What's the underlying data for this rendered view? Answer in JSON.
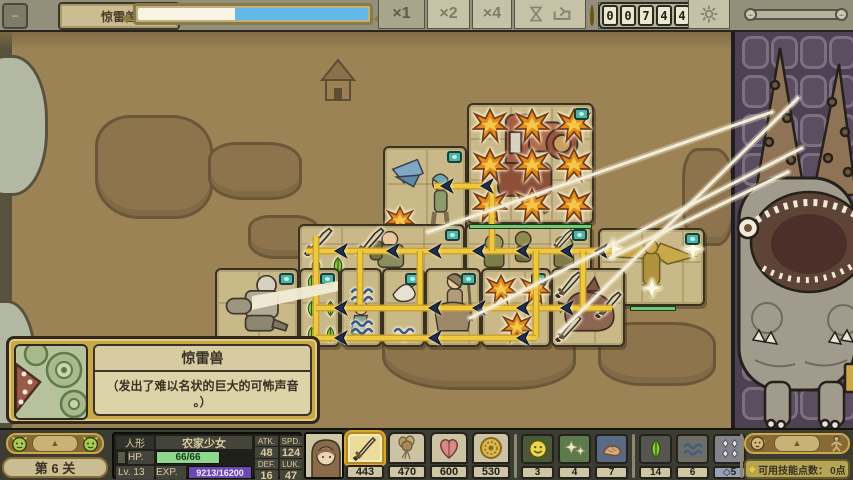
{
  "top_bar": {
    "minimize_icon": "circle-minus-icon",
    "enemy_name": "惊雷兽",
    "enemy_hp_left_pct": 42,
    "speed_options": [
      {
        "label": "×1",
        "active": true
      },
      {
        "label": "×2",
        "active": false
      },
      {
        "label": "×4",
        "active": false
      }
    ],
    "coin_digits": [
      "0",
      "0",
      "7",
      "4",
      "4"
    ],
    "colors": {
      "hp_left": "#f7f4e4",
      "hp_right": "#62b8e8",
      "coin": "#e0bc3e"
    }
  },
  "board": {
    "blocks": [
      {
        "name": "mech-block",
        "x": 467,
        "y": 73,
        "w": 127,
        "h": 121,
        "badge": true,
        "art": "mech",
        "hp": {
          "x": 0,
          "w": 123
        },
        "icons": [
          [
            "burst",
            3,
            3,
            36
          ],
          [
            "burst",
            45,
            3,
            36
          ],
          [
            "burst",
            87,
            3,
            36
          ],
          [
            "burst",
            3,
            43,
            36
          ],
          [
            "burst",
            45,
            43,
            36
          ],
          [
            "burst",
            87,
            43,
            36
          ],
          [
            "burst",
            3,
            83,
            36
          ],
          [
            "burst",
            45,
            83,
            36
          ],
          [
            "burst",
            87,
            83,
            36
          ]
        ]
      },
      {
        "name": "scout-block",
        "x": 383,
        "y": 116,
        "w": 84,
        "h": 123,
        "badge": true,
        "art": "birdgirl",
        "icons": [
          [
            "burst",
            0,
            58,
            30
          ]
        ]
      },
      {
        "name": "sword-row-block",
        "x": 298,
        "y": 194,
        "w": 167,
        "h": 64,
        "badge": true,
        "art": "soldier",
        "icons": [
          [
            "sword",
            4,
            0,
            30
          ],
          [
            "sword",
            56,
            0,
            30
          ],
          [
            "seed",
            6,
            30,
            20
          ],
          [
            "seed",
            28,
            30,
            20
          ]
        ]
      },
      {
        "name": "goblin-block",
        "x": 465,
        "y": 194,
        "w": 127,
        "h": 64,
        "badge": true,
        "art": "goblins",
        "icons": [
          [
            "sword",
            84,
            2,
            24
          ]
        ]
      },
      {
        "name": "eagle-block",
        "x": 598,
        "y": 198,
        "w": 107,
        "h": 78,
        "badge": true,
        "art": "eagle",
        "hp": {
          "x": 30,
          "w": 46
        },
        "icons": [
          [
            "star",
            2,
            8,
            22
          ],
          [
            "star",
            82,
            8,
            22
          ],
          [
            "star",
            42,
            48,
            20
          ]
        ]
      },
      {
        "name": "robot-block",
        "x": 215,
        "y": 238,
        "w": 84,
        "h": 79,
        "badge": true,
        "art": "robot",
        "icons": []
      },
      {
        "name": "seed-block",
        "x": 299,
        "y": 238,
        "w": 41,
        "h": 79,
        "badge": true,
        "icons": [
          [
            "seed",
            2,
            4,
            17
          ],
          [
            "seed",
            21,
            4,
            17
          ],
          [
            "seed",
            2,
            30,
            17
          ],
          [
            "seed",
            21,
            30,
            17
          ],
          [
            "seed",
            2,
            56,
            17
          ],
          [
            "seed",
            21,
            56,
            17
          ]
        ]
      },
      {
        "name": "wave-block",
        "x": 340,
        "y": 238,
        "w": 42,
        "h": 79,
        "badge": false,
        "art": "mermaid",
        "icons": [
          [
            "wave",
            7,
            12,
            26
          ],
          [
            "wave",
            7,
            44,
            26
          ]
        ]
      },
      {
        "name": "swan-block",
        "x": 382,
        "y": 238,
        "w": 43,
        "h": 79,
        "badge": true,
        "art": "swan",
        "icons": [
          [
            "wave",
            8,
            52,
            24
          ]
        ]
      },
      {
        "name": "rider-block",
        "x": 425,
        "y": 238,
        "w": 56,
        "h": 79,
        "badge": true,
        "art": "rider",
        "icons": []
      },
      {
        "name": "burst-block",
        "x": 481,
        "y": 238,
        "w": 70,
        "h": 79,
        "badge": true,
        "icons": [
          [
            "burst",
            2,
            4,
            32
          ],
          [
            "burst",
            36,
            4,
            32
          ],
          [
            "burst",
            18,
            42,
            32
          ]
        ]
      },
      {
        "name": "dragon-block",
        "x": 551,
        "y": 238,
        "w": 74,
        "h": 79,
        "badge": false,
        "art": "dragon",
        "icons": [
          [
            "sword",
            2,
            0,
            28
          ],
          [
            "sword",
            2,
            44,
            28
          ],
          [
            "sword",
            42,
            20,
            28
          ]
        ]
      }
    ],
    "connectors": [
      [
        306,
        221,
        612,
        221
      ],
      [
        316,
        206,
        316,
        310
      ],
      [
        360,
        221,
        360,
        278
      ],
      [
        420,
        221,
        420,
        278
      ],
      [
        316,
        278,
        612,
        278
      ],
      [
        492,
        156,
        492,
        221
      ],
      [
        434,
        156,
        492,
        156
      ],
      [
        536,
        221,
        536,
        308
      ],
      [
        316,
        308,
        536,
        308
      ],
      [
        583,
        221,
        583,
        278
      ]
    ],
    "arrows": [
      [
        340,
        221
      ],
      [
        392,
        221
      ],
      [
        434,
        221
      ],
      [
        478,
        221
      ],
      [
        522,
        221
      ],
      [
        566,
        221
      ],
      [
        600,
        221
      ],
      [
        446,
        156
      ],
      [
        486,
        156
      ],
      [
        340,
        278
      ],
      [
        434,
        278
      ],
      [
        478,
        278
      ],
      [
        522,
        278
      ],
      [
        566,
        278
      ],
      [
        340,
        308
      ],
      [
        434,
        308
      ],
      [
        522,
        308
      ]
    ],
    "streaks": [
      [
        470,
        288,
        802,
        118
      ],
      [
        560,
        302,
        798,
        68
      ],
      [
        428,
        202,
        772,
        82
      ],
      [
        610,
        228,
        788,
        142
      ]
    ]
  },
  "enemy_panel": {
    "grid_cols": 4,
    "grid_rows": 10,
    "monster_name": "惊雷兽"
  },
  "tooltip": {
    "title": "惊雷兽",
    "desc_line1": "（发出了难以名状的巨大的可怖声音",
    "desc_line2": "。）"
  },
  "bottom_bar": {
    "level_label": "第 6 关",
    "triangle_glyph": "▲",
    "character": {
      "race": "人形",
      "name": "农家少女",
      "hp_label": "HP.",
      "hp_value": "66/66",
      "level_label": "Lv.",
      "level": "13",
      "exp_label": "EXP.",
      "exp_value": "9213/16200",
      "stats": [
        {
          "k": "ATK.",
          "v": "48"
        },
        {
          "k": "SPD.",
          "v": "124"
        },
        {
          "k": "DEF.",
          "v": "16"
        },
        {
          "k": "LUK.",
          "v": "47"
        }
      ]
    },
    "items": [
      {
        "icon": "sword-icon",
        "count": "443",
        "selected": true
      },
      {
        "icon": "bouquet-icon",
        "count": "470",
        "selected": false
      },
      {
        "icon": "heart-icon",
        "count": "600",
        "selected": false
      },
      {
        "icon": "medal-icon",
        "count": "530",
        "selected": false
      }
    ],
    "tokens_a": [
      {
        "icon": "smiley-icon",
        "count": "3"
      },
      {
        "icon": "sparkle-icon",
        "count": "4"
      },
      {
        "icon": "worm-icon",
        "count": "7"
      }
    ],
    "tokens_b": [
      {
        "icon": "seed-icon",
        "count": "14"
      },
      {
        "icon": "wave-icon",
        "count": "6"
      },
      {
        "icon": "diamonds-icon",
        "count": "5",
        "prefix": "◇"
      }
    ],
    "skill_points_label": "可用技能点数：",
    "skill_points_value": "0点"
  }
}
